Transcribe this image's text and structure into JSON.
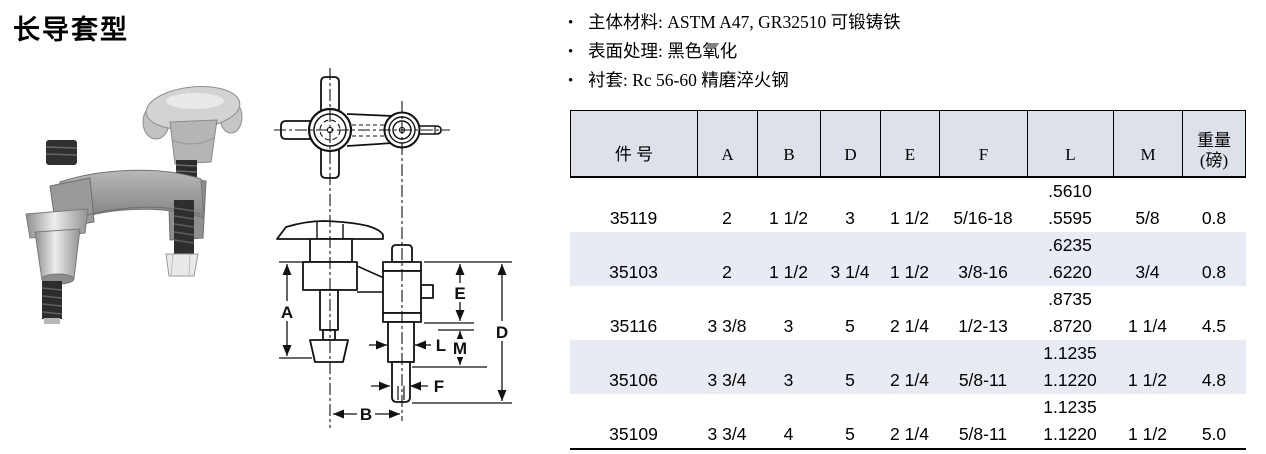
{
  "title": "长导套型",
  "bullet_marker": "•",
  "bullets": [
    "主体材料: ASTM A47, GR32510 可锻铸铁",
    "表面处理: 黑色氧化",
    "衬套: Rc 56-60 精磨淬火钢"
  ],
  "diagram": {
    "dim_labels": {
      "A": "A",
      "B": "B",
      "D": "D",
      "E": "E",
      "L": "L",
      "M": "M",
      "F": "F"
    }
  },
  "table": {
    "headers": [
      "件 号",
      "A",
      "B",
      "D",
      "E",
      "F",
      "L",
      "M"
    ],
    "weight_header": {
      "line1": "重量",
      "line2": "(磅)"
    },
    "rows": [
      {
        "part": "35119",
        "A": "2",
        "B": "1 1/2",
        "D": "3",
        "E": "1 1/2",
        "F": "5/16-18",
        "L1": ".5610",
        "L2": ".5595",
        "M": "5/8",
        "weight": "0.8"
      },
      {
        "part": "35103",
        "A": "2",
        "B": "1 1/2",
        "D": "3 1/4",
        "E": "1 1/2",
        "F": "3/8-16",
        "L1": ".6235",
        "L2": ".6220",
        "M": "3/4",
        "weight": "0.8"
      },
      {
        "part": "35116",
        "A": "3 3/8",
        "B": "3",
        "D": "5",
        "E": "2 1/4",
        "F": "1/2-13",
        "L1": ".8735",
        "L2": ".8720",
        "M": "1 1/4",
        "weight": "4.5"
      },
      {
        "part": "35106",
        "A": "3 3/4",
        "B": "3",
        "D": "5",
        "E": "2 1/4",
        "F": "5/8-11",
        "L1": "1.1235",
        "L2": "1.1220",
        "M": "1 1/2",
        "weight": "4.8"
      },
      {
        "part": "35109",
        "A": "3 3/4",
        "B": "4",
        "D": "5",
        "E": "2 1/4",
        "F": "5/8-11",
        "L1": "1.1235",
        "L2": "1.1220",
        "M": "1 1/2",
        "weight": "5.0"
      }
    ]
  },
  "colors": {
    "table_header_bg": "#dee1ea",
    "table_stripe_bg": "#e9ebf4",
    "line": "#111111"
  }
}
